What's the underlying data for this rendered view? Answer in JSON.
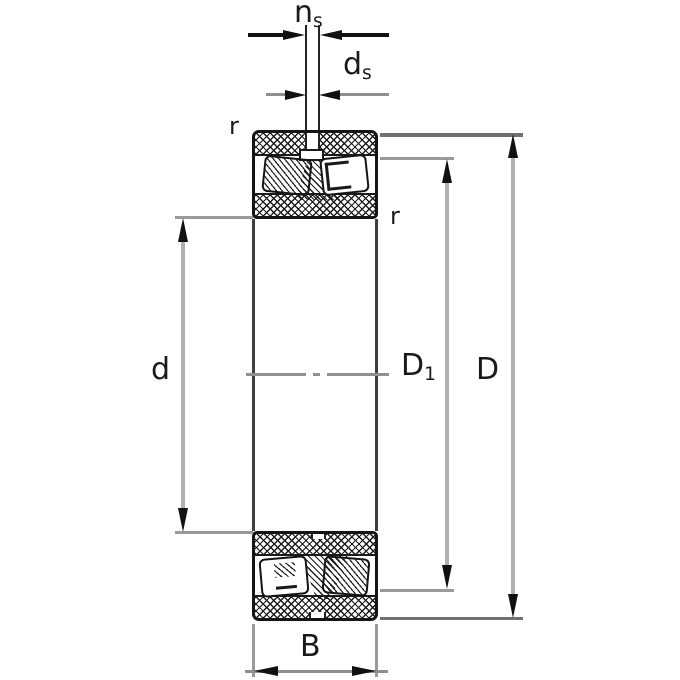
{
  "diagram": {
    "kind": "spherical-roller-bearing-cross-section-drawing",
    "dimension_labels": {
      "ns": {
        "base": "n",
        "sub": "s"
      },
      "ds": {
        "base": "d",
        "sub": "s"
      },
      "r_top": "r",
      "r_inner": "r",
      "d": "d",
      "D1": {
        "base": "D",
        "sub": "1"
      },
      "D": "D",
      "B": "B"
    },
    "colors": {
      "line": "#1a1a1a",
      "dimension_line": "#8f8f8f",
      "extension_line": "#9a9a9a",
      "arrow": "#111111",
      "background": "#ffffff"
    }
  }
}
